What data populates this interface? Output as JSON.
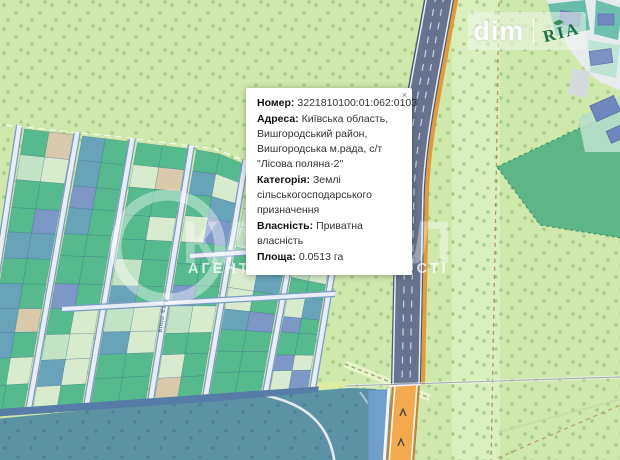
{
  "popup": {
    "rows": [
      {
        "label": "Номер:",
        "text": "3221810100:01:062:0103"
      },
      {
        "label": "Адреса:",
        "text": "Київська область, Вишгородський район, Вишгородська м.рада, с/т \"Лісова поляна-2\""
      },
      {
        "label": "Категорія:",
        "text": "Землі сільськогосподарського призначення"
      },
      {
        "label": "Власність:",
        "text": "Приватна власність"
      },
      {
        "label": "Площа:",
        "text": "0.0513 га"
      }
    ],
    "close_label": "×"
  },
  "logo": {
    "dim": "dim",
    "ria": "RIA"
  },
  "watermark": {
    "big": "КАПІТАЛ",
    "line": "АГЕНТСТВО НЕРУХОМОСТІ"
  },
  "map": {
    "street_labels": [
      "4-та лінія",
      "7-ма лінія",
      "8-ма лінія"
    ],
    "selected_parcel_color": "#e3261c",
    "palette": {
      "green": "#56ba8e",
      "pale": "#d9ebce",
      "mint": "#c3e3c6",
      "teal": "#68a3ba",
      "blue": "#7d97c7",
      "beige": "#d8c9ab"
    },
    "forest": "#cfe8ac",
    "water_zone": "#5b92a4"
  }
}
